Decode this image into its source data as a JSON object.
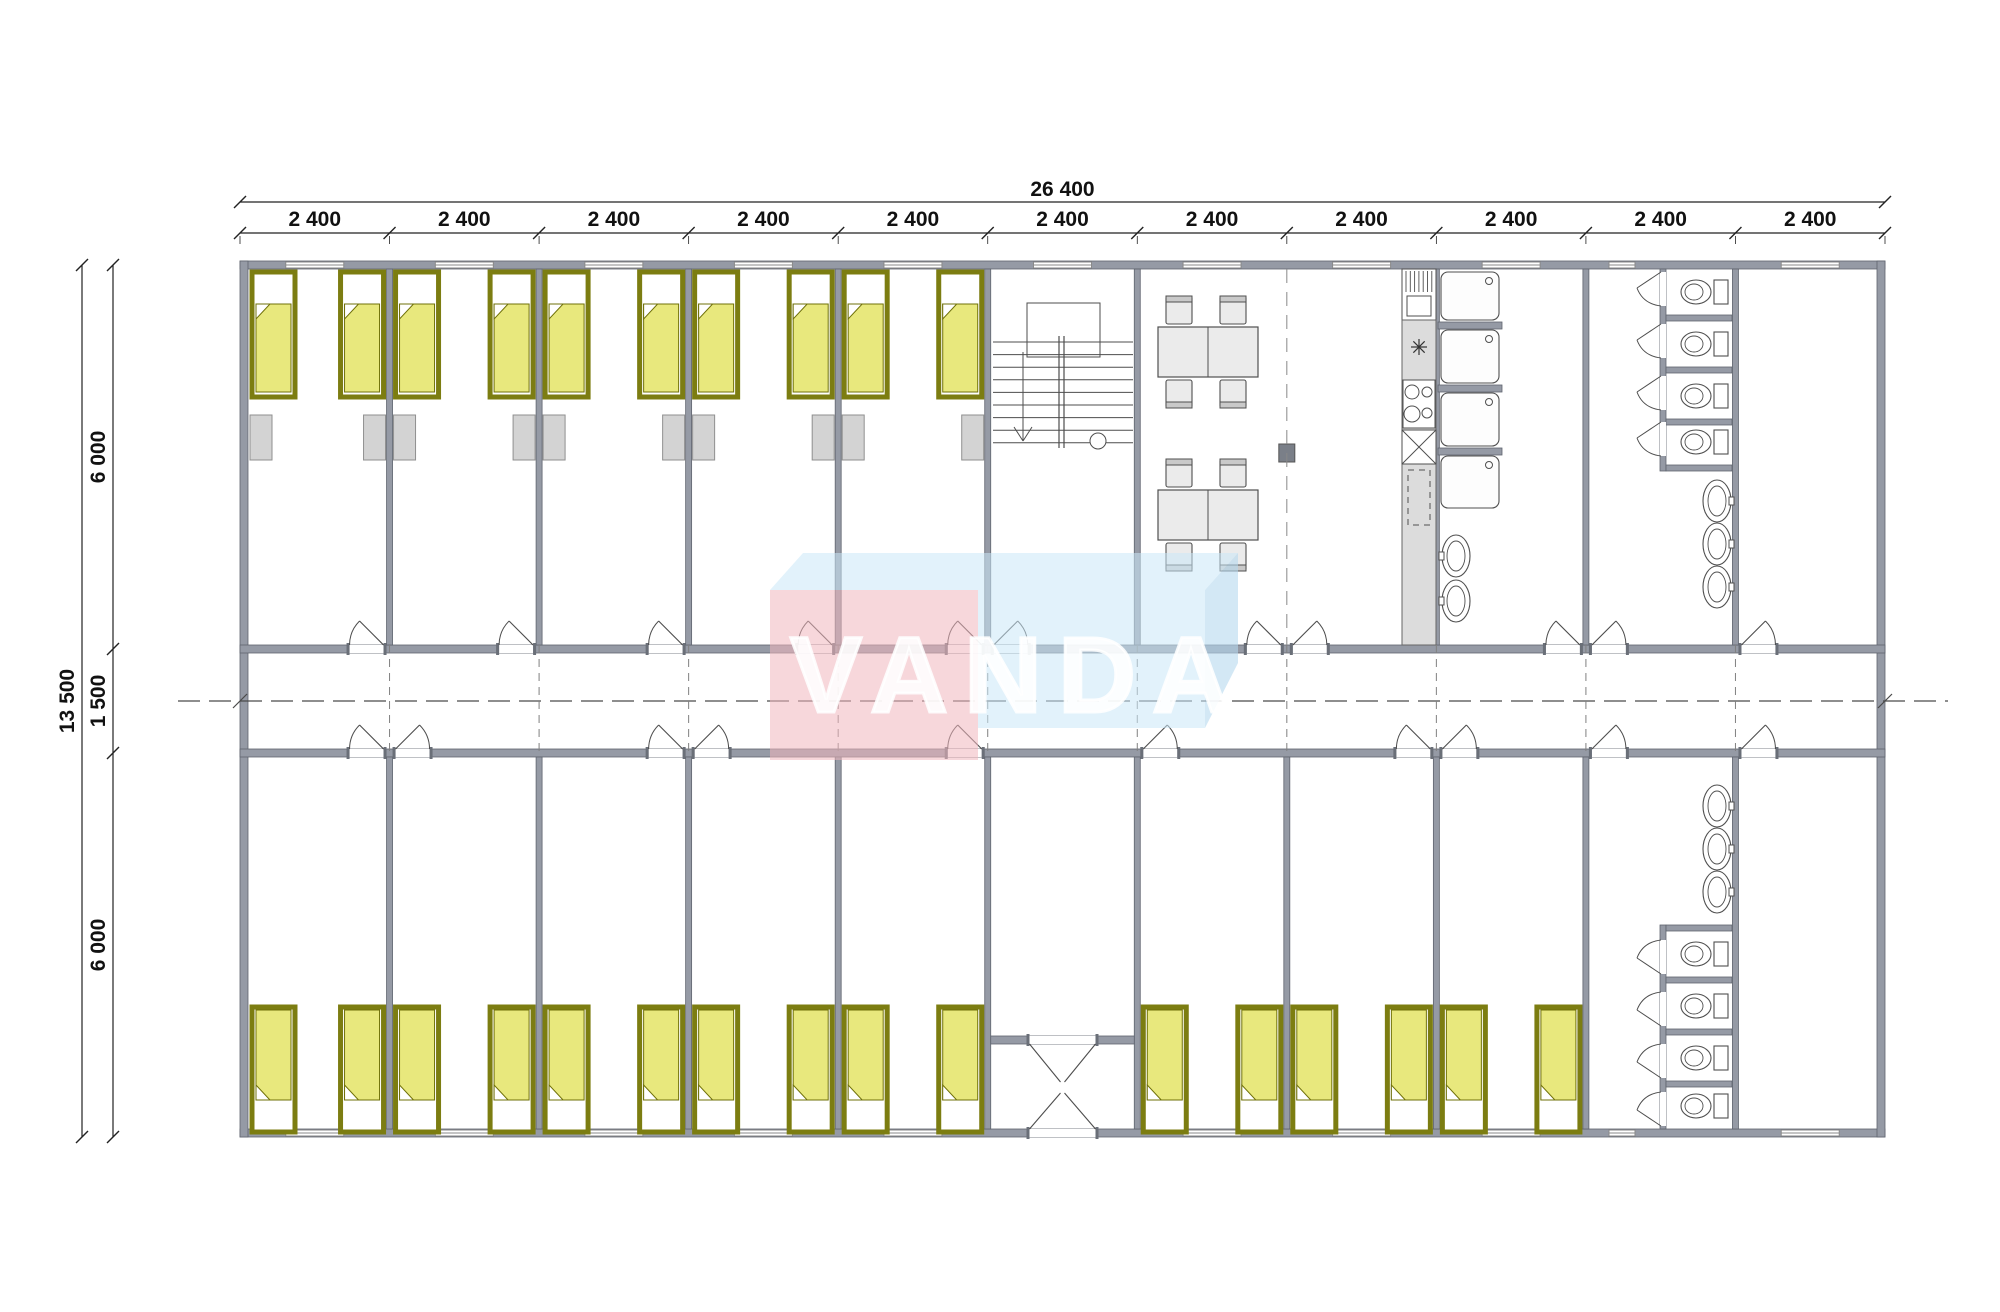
{
  "watermark": {
    "text": "VANDA"
  },
  "dims": {
    "total_w": "26 400",
    "module_w": "2 400",
    "module_dim_labels": [
      "2 400",
      "2 400",
      "2 400",
      "2 400",
      "2 400",
      "2 400",
      "2 400",
      "2 400",
      "2 400",
      "2 400",
      "2 400"
    ],
    "module_count": 11,
    "total_h": "13 500",
    "top_depth": "6 000",
    "corridor": "1 500",
    "bottom_depth": "6 000"
  },
  "top_modules": [
    {
      "type": "bedroom",
      "beds": 2,
      "lockers": 2,
      "window": true
    },
    {
      "type": "bedroom",
      "beds": 2,
      "lockers": 2,
      "window": true
    },
    {
      "type": "bedroom",
      "beds": 2,
      "lockers": 2,
      "window": true
    },
    {
      "type": "bedroom",
      "beds": 2,
      "lockers": 2,
      "window": true
    },
    {
      "type": "bedroom",
      "beds": 2,
      "lockers": 2,
      "window": true
    },
    {
      "type": "staircase",
      "window": true
    },
    {
      "type": "dining",
      "tables": 1,
      "chairs": 4,
      "window": true
    },
    {
      "type": "dining-kitchen",
      "tables": 1,
      "chairs": 4,
      "window": true
    },
    {
      "type": "showers",
      "stalls": 4,
      "basins": 2,
      "window": true
    },
    {
      "type": "toilets",
      "stalls": 4,
      "basins": 3,
      "window": true
    },
    {
      "type": "empty",
      "window": true
    }
  ],
  "bottom_modules": [
    {
      "type": "bedroom",
      "beds": 2,
      "window": true
    },
    {
      "type": "bedroom",
      "beds": 2,
      "window": true
    },
    {
      "type": "bedroom",
      "beds": 2,
      "window": true
    },
    {
      "type": "bedroom",
      "beds": 2,
      "window": true
    },
    {
      "type": "bedroom",
      "beds": 2,
      "window": true
    },
    {
      "type": "entrance-vestibule",
      "double_doors": 2
    },
    {
      "type": "bedroom",
      "beds": 2,
      "window": true
    },
    {
      "type": "bedroom",
      "beds": 2,
      "window": true
    },
    {
      "type": "bedroom",
      "beds": 2,
      "window": true
    },
    {
      "type": "toilets",
      "stalls": 4,
      "basins": 3,
      "window": true
    },
    {
      "type": "empty",
      "window": true
    }
  ],
  "counts": {
    "beds_total": 26,
    "lockers": 10,
    "shower_stalls": 4,
    "wc_stalls": 8,
    "wash_basins": 8,
    "dining_tables": 2,
    "dining_chairs": 8
  },
  "colors": {
    "wall": "#959aa5",
    "wallEdge": "#5f646e",
    "line": "#4d4d4d",
    "bedFrame": "#7c7d11",
    "bedFill": "#e8e87d",
    "bedLine": "#6f7009",
    "locker": "#d3d3d3",
    "lockerEdge": "#8f8f8f",
    "furnFill": "#ebebeb",
    "furnEdge": "#4f4f4f",
    "counter": "#dcdcdc",
    "dash": "#4a4a4a",
    "dim": "#111111",
    "post": "#7a7f88",
    "wmPink": "#f0b6be",
    "wmBlue": "#cbe7f7",
    "wmBlueSide": "#b5d9ef",
    "wmText": "#ffffff"
  }
}
